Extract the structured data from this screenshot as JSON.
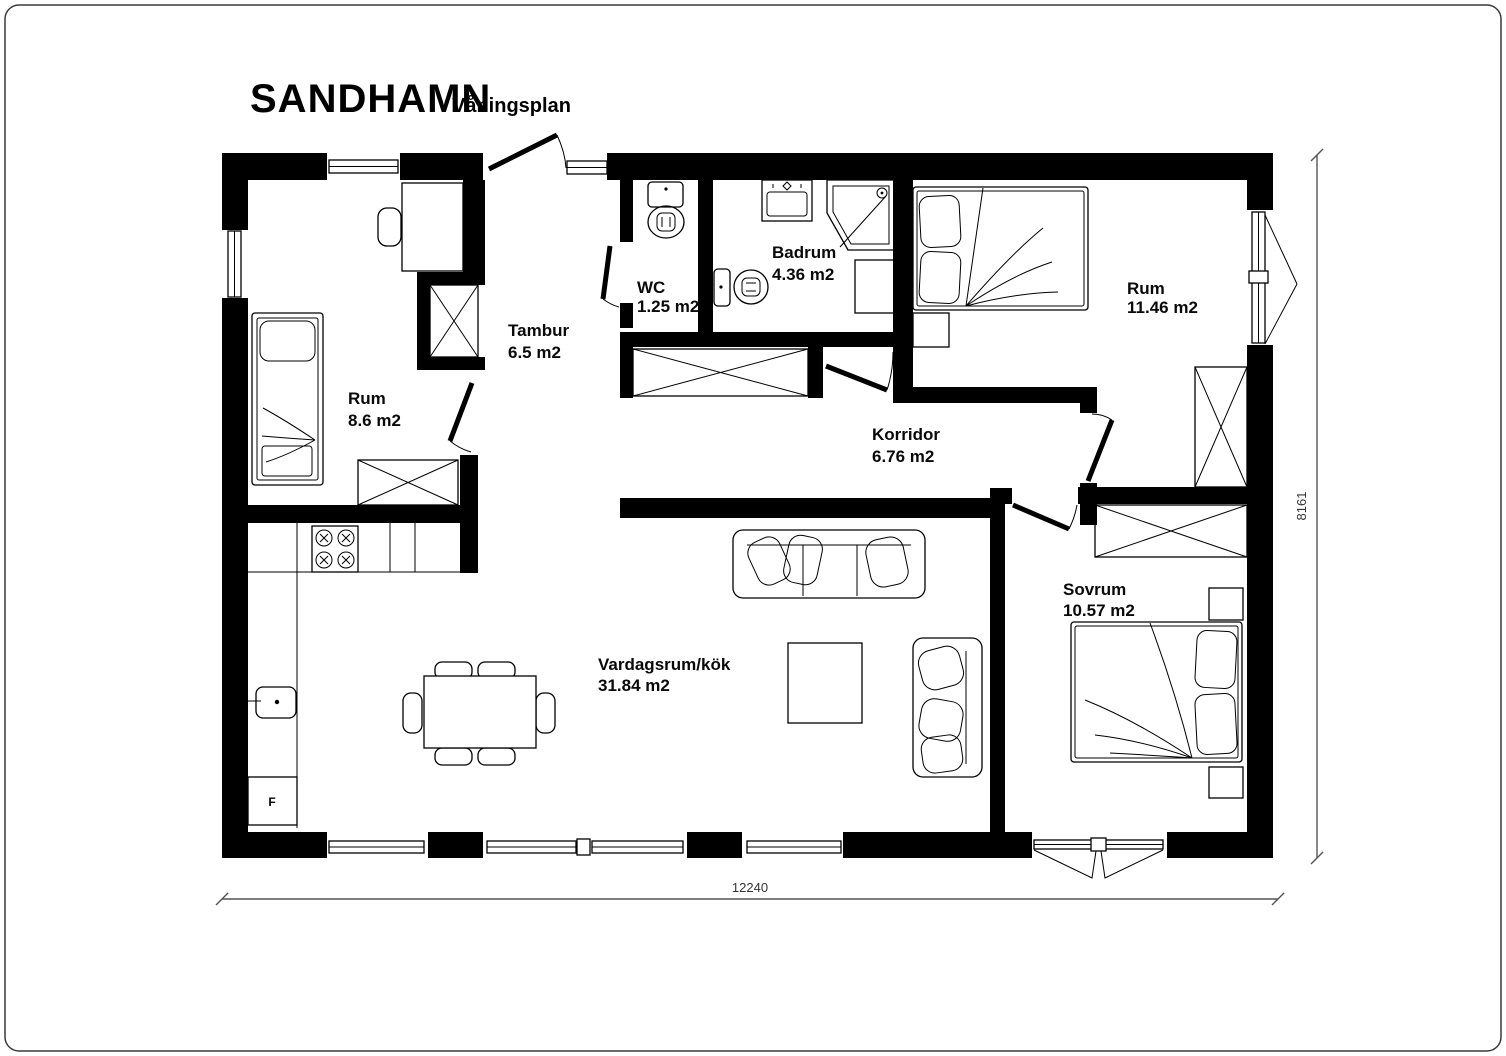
{
  "title": {
    "main": "SANDHAMN",
    "sub": "Våningsplan"
  },
  "rooms": [
    {
      "name": "Rum",
      "area": "8.6 m2"
    },
    {
      "name": "Tambur",
      "area": "6.5 m2"
    },
    {
      "name": "WC",
      "area": "1.25 m2"
    },
    {
      "name": "Badrum",
      "area": "4.36 m2"
    },
    {
      "name": "Rum",
      "area": "11.46 m2"
    },
    {
      "name": "Korridor",
      "area": "6.76 m2"
    },
    {
      "name": "Sovrum",
      "area": "10.57 m2"
    },
    {
      "name": "Vardagsrum/kök",
      "area": "31.84 m2"
    }
  ],
  "dimensions": {
    "width_mm": "12240",
    "height_mm": "8161"
  },
  "appliances": {
    "fridge_label": "F"
  },
  "colors": {
    "wall": "#000000",
    "line": "#000000",
    "dimension": "#555555",
    "background": "#ffffff"
  }
}
